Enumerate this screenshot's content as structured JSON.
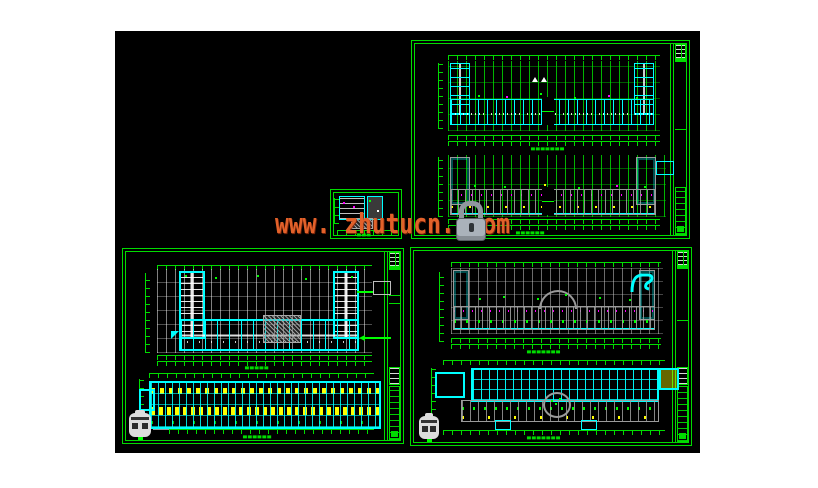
{
  "note": "CAD viewport screenshot; all drawing captions are sub-5px and illegible at source resolution, represented as glyph blocks",
  "page": {
    "background": "#ffffff"
  },
  "viewport": {
    "background": "#000000"
  },
  "watermark": {
    "text": "www. zhutucn. com",
    "color": "#e2612a",
    "icon": "padlock-icon"
  },
  "palette": {
    "sheet_frame_green": "#00dc00",
    "wall_cyan": "#00ffff",
    "dimension_green": "#00ff00",
    "detail_magenta": "#ff00ff",
    "room_yellow": "#ffff00",
    "line_gray": "#9a9a9a",
    "line_white": "#ffffff"
  },
  "sheets": [
    {
      "id": "sheet-top-right",
      "caption_top": "▄▄▄▄▄▄▄",
      "caption_bottom": "▄▄▄▄▄▄"
    },
    {
      "id": "sheet-small-detail",
      "caption": "▄▄▄"
    },
    {
      "id": "sheet-bottom-left",
      "caption_top": "▄▄▄▄▄",
      "caption_bottom": "▄▄▄▄▄▄"
    },
    {
      "id": "sheet-bottom-right",
      "caption_top": "▄▄▄▄▄▄▄",
      "caption_bottom": "▄▄▄▄▄▄▄"
    }
  ]
}
